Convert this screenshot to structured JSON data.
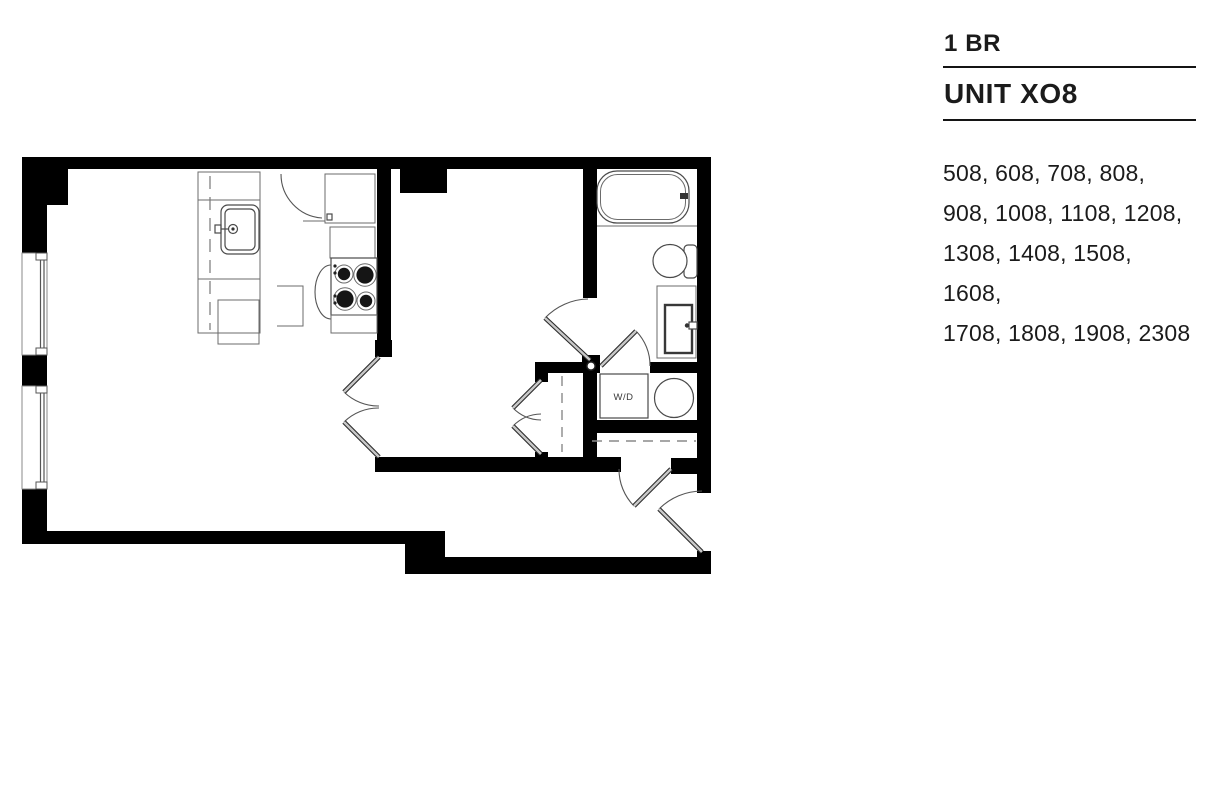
{
  "page": {
    "width": 1228,
    "height": 794,
    "background": "#ffffff"
  },
  "info_panel": {
    "bedroom_type": "1 BR",
    "unit_title": "UNIT XO8",
    "unit_numbers": [
      "508",
      "608",
      "708",
      "808",
      "908",
      "1008",
      "1108",
      "1208",
      "1308",
      "1408",
      "1508",
      "1608",
      "1708",
      "1808",
      "1908",
      "2308"
    ],
    "unit_numbers_lines": [
      "508, 608, 708, 808,",
      "908, 1008, 1108, 1208,",
      "1308, 1408, 1508, 1608,",
      "1708, 1808, 1908, 2308"
    ]
  },
  "floor_plan": {
    "wd_label": "W/D",
    "fixtures": [
      "kitchen-sink",
      "dishwasher",
      "refrigerator",
      "stove",
      "upper-cabinets",
      "bathtub",
      "toilet",
      "vanity-sink",
      "washer-dryer",
      "bedroom-closet-rod",
      "entry-closet-shelf",
      "window",
      "window",
      "bedroom-french-doors",
      "closet-double-doors",
      "bedroom-hall-door",
      "bathroom-door",
      "entry-closet-door",
      "front-door"
    ]
  },
  "theme": {
    "background": "#ffffff",
    "wall": "#000000",
    "fixture_line": "#4a4a4a",
    "light_line": "#6b6b6b",
    "door_leaf_fill": "#c8c8c8",
    "door_leaf_edge": "#2a2a2a",
    "door_arc": "#555555",
    "dash_line": "#8a8a8a",
    "text": "#1b1b1b",
    "rule": "#141414"
  }
}
